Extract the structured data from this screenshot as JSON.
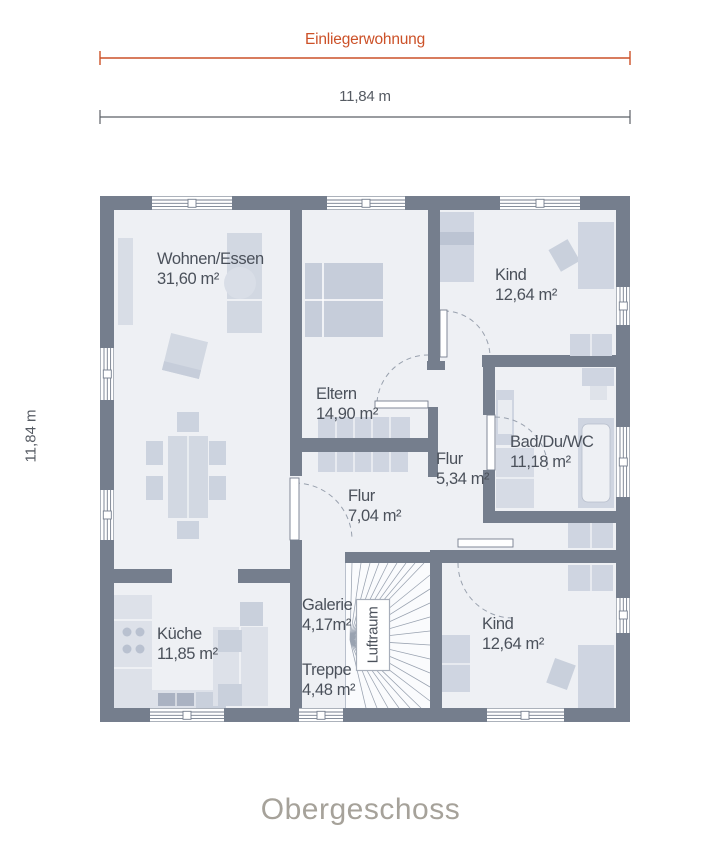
{
  "header": {
    "zone_label": "Einliegerwohnung",
    "width_dim": "11,84 m"
  },
  "left_dim": "11,84 m",
  "rooms": [
    {
      "id": "wohnen-essen",
      "name": "Wohnen/Essen",
      "area": "31,60 m²"
    },
    {
      "id": "eltern",
      "name": "Eltern",
      "area": "14,90 m²"
    },
    {
      "id": "kind-top",
      "name": "Kind",
      "area": "12,64 m²"
    },
    {
      "id": "bad-du-wc",
      "name": "Bad/Du/WC",
      "area": "11,18 m²"
    },
    {
      "id": "flur-klein",
      "name": "Flur",
      "area": "5,34 m²"
    },
    {
      "id": "flur-gross",
      "name": "Flur",
      "area": "7,04 m²"
    },
    {
      "id": "galerie",
      "name": "Galerie",
      "area": "4,17m²"
    },
    {
      "id": "treppe",
      "name": "Treppe",
      "area": "4,48 m²"
    },
    {
      "id": "kueche",
      "name": "Küche",
      "area": "11,85 m²"
    },
    {
      "id": "kind-bottom",
      "name": "Kind",
      "area": "12,64 m²"
    }
  ],
  "stairwell": {
    "void_label": "Luftraum"
  },
  "footer": {
    "title": "Obergeschoss"
  },
  "colors": {
    "accent": "#CC5128",
    "walls": "#757E8D",
    "floor": "#EEF0F4",
    "furniture_light": "#D2D8E2",
    "furniture_medium": "#C6CDDA",
    "label_text": "#4B515B",
    "title_text": "#A6A29A"
  }
}
